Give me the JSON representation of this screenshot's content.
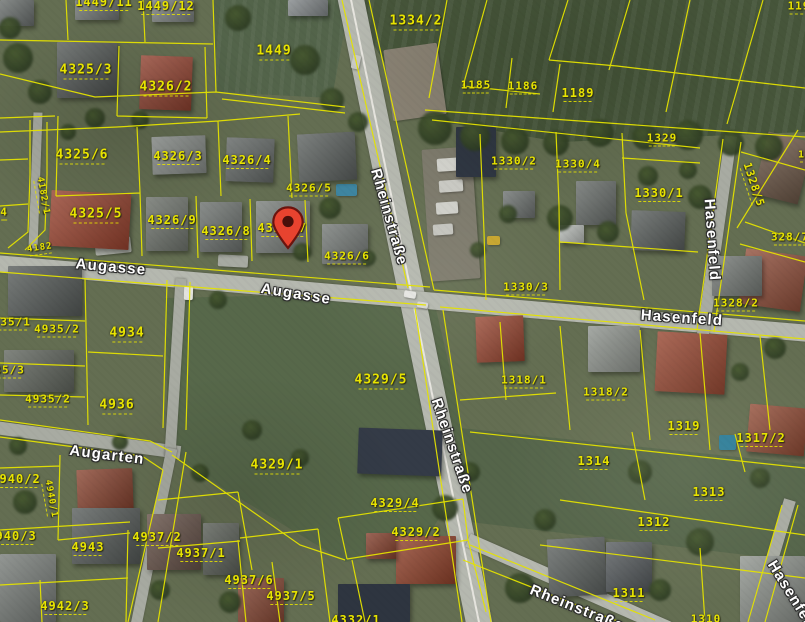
{
  "map": {
    "type": "aerial-cadastral-view",
    "colors": {
      "parcel_line": "#e4e200",
      "parcel_label": "#e8e400",
      "street_label": "#ffffff",
      "marker": "#e8432f"
    },
    "marker": {
      "name": "location-marker",
      "tip_x": 288,
      "tip_y": 249
    },
    "parcel_labels": [
      {
        "text": "1449/11",
        "x": 104,
        "y": 3,
        "size": 12
      },
      {
        "text": "1449/12",
        "x": 166,
        "y": 7,
        "size": 12
      },
      {
        "text": "1334/2",
        "x": 416,
        "y": 22,
        "size": 13
      },
      {
        "text": "1449",
        "x": 274,
        "y": 52,
        "size": 13
      },
      {
        "text": "1185",
        "x": 476,
        "y": 86,
        "size": 11
      },
      {
        "text": "1186",
        "x": 523,
        "y": 87,
        "size": 11
      },
      {
        "text": "1189",
        "x": 578,
        "y": 94,
        "size": 12
      },
      {
        "text": "119",
        "x": 799,
        "y": 7,
        "size": 11
      },
      {
        "text": "4325/3",
        "x": 86,
        "y": 71,
        "size": 13
      },
      {
        "text": "4326/2",
        "x": 166,
        "y": 88,
        "size": 13
      },
      {
        "text": "4325/6",
        "x": 82,
        "y": 156,
        "size": 13
      },
      {
        "text": "4326/3",
        "x": 178,
        "y": 157,
        "size": 12
      },
      {
        "text": "4326/4",
        "x": 247,
        "y": 161,
        "size": 12
      },
      {
        "text": "4325/5",
        "x": 96,
        "y": 215,
        "size": 13
      },
      {
        "text": "4326/9",
        "x": 172,
        "y": 221,
        "size": 12
      },
      {
        "text": "4326/8",
        "x": 226,
        "y": 232,
        "size": 12
      },
      {
        "text": "4326/7",
        "x": 282,
        "y": 229,
        "size": 12
      },
      {
        "text": "4326/5",
        "x": 309,
        "y": 189,
        "size": 11
      },
      {
        "text": "4326/6",
        "x": 347,
        "y": 257,
        "size": 11
      },
      {
        "text": "4",
        "x": 4,
        "y": 213,
        "size": 11
      },
      {
        "text": "4182/1",
        "x": 42,
        "y": 196,
        "size": 9,
        "rot": 80
      },
      {
        "text": "4182",
        "x": 40,
        "y": 249,
        "size": 9,
        "rot": -8
      },
      {
        "text": "1330/2",
        "x": 514,
        "y": 162,
        "size": 11
      },
      {
        "text": "1330/4",
        "x": 578,
        "y": 165,
        "size": 11
      },
      {
        "text": "1329",
        "x": 662,
        "y": 139,
        "size": 11
      },
      {
        "text": "1330/1",
        "x": 659,
        "y": 194,
        "size": 12
      },
      {
        "text": "1328/5",
        "x": 753,
        "y": 185,
        "size": 11,
        "rot": 72
      },
      {
        "text": "1328",
        "x": 812,
        "y": 156,
        "size": 10
      },
      {
        "text": "328/7",
        "x": 790,
        "y": 238,
        "size": 11
      },
      {
        "text": "1328/2",
        "x": 736,
        "y": 304,
        "size": 11
      },
      {
        "text": "1330/3",
        "x": 526,
        "y": 288,
        "size": 11
      },
      {
        "text": "4934",
        "x": 127,
        "y": 334,
        "size": 13
      },
      {
        "text": "4935/1",
        "x": 8,
        "y": 323,
        "size": 11
      },
      {
        "text": "4935/2",
        "x": 57,
        "y": 330,
        "size": 11
      },
      {
        "text": "4935/3",
        "x": 2,
        "y": 371,
        "size": 11
      },
      {
        "text": "4935/2",
        "x": 48,
        "y": 400,
        "size": 11
      },
      {
        "text": "4936",
        "x": 117,
        "y": 406,
        "size": 13
      },
      {
        "text": "4329/5",
        "x": 381,
        "y": 381,
        "size": 13
      },
      {
        "text": "4329/1",
        "x": 277,
        "y": 466,
        "size": 13
      },
      {
        "text": "1318/1",
        "x": 524,
        "y": 381,
        "size": 11
      },
      {
        "text": "1318/2",
        "x": 606,
        "y": 393,
        "size": 11
      },
      {
        "text": "4940/2",
        "x": 16,
        "y": 480,
        "size": 12
      },
      {
        "text": "4940/1",
        "x": 50,
        "y": 499,
        "size": 9,
        "rot": 80
      },
      {
        "text": "1319",
        "x": 684,
        "y": 427,
        "size": 12
      },
      {
        "text": "1317/2",
        "x": 761,
        "y": 439,
        "size": 12
      },
      {
        "text": "1314",
        "x": 594,
        "y": 462,
        "size": 12
      },
      {
        "text": "1313",
        "x": 709,
        "y": 493,
        "size": 12
      },
      {
        "text": "1312",
        "x": 654,
        "y": 523,
        "size": 12
      },
      {
        "text": "1311",
        "x": 629,
        "y": 594,
        "size": 12
      },
      {
        "text": "1310",
        "x": 706,
        "y": 620,
        "size": 11
      },
      {
        "text": "4940/3",
        "x": 12,
        "y": 537,
        "size": 12
      },
      {
        "text": "4943",
        "x": 88,
        "y": 548,
        "size": 12
      },
      {
        "text": "4937/2",
        "x": 157,
        "y": 538,
        "size": 12
      },
      {
        "text": "4937/1",
        "x": 201,
        "y": 554,
        "size": 12
      },
      {
        "text": "4937/6",
        "x": 249,
        "y": 581,
        "size": 12
      },
      {
        "text": "4937/5",
        "x": 291,
        "y": 597,
        "size": 12
      },
      {
        "text": "4942/3",
        "x": 65,
        "y": 607,
        "size": 12
      },
      {
        "text": "4329/4",
        "x": 395,
        "y": 504,
        "size": 12
      },
      {
        "text": "4329/2",
        "x": 416,
        "y": 533,
        "size": 12
      },
      {
        "text": "4332/1",
        "x": 356,
        "y": 621,
        "size": 12
      }
    ],
    "street_labels": [
      {
        "text": "Augasse",
        "x": 111,
        "y": 267,
        "rot": 5
      },
      {
        "text": "Augasse",
        "x": 296,
        "y": 294,
        "rot": 9
      },
      {
        "text": "Rheinstraße",
        "x": 389,
        "y": 217,
        "rot": 74
      },
      {
        "text": "Rheinstraße",
        "x": 452,
        "y": 446,
        "rot": 71
      },
      {
        "text": "Rheinstraße",
        "x": 577,
        "y": 608,
        "rot": 22
      },
      {
        "text": "Hasenfeld",
        "x": 682,
        "y": 318,
        "rot": 4
      },
      {
        "text": "Hasenfeld",
        "x": 712,
        "y": 240,
        "rot": 86
      },
      {
        "text": "Hasenfeld",
        "x": 793,
        "y": 597,
        "rot": 58
      },
      {
        "text": "Augarten",
        "x": 107,
        "y": 455,
        "rot": 7
      }
    ]
  }
}
